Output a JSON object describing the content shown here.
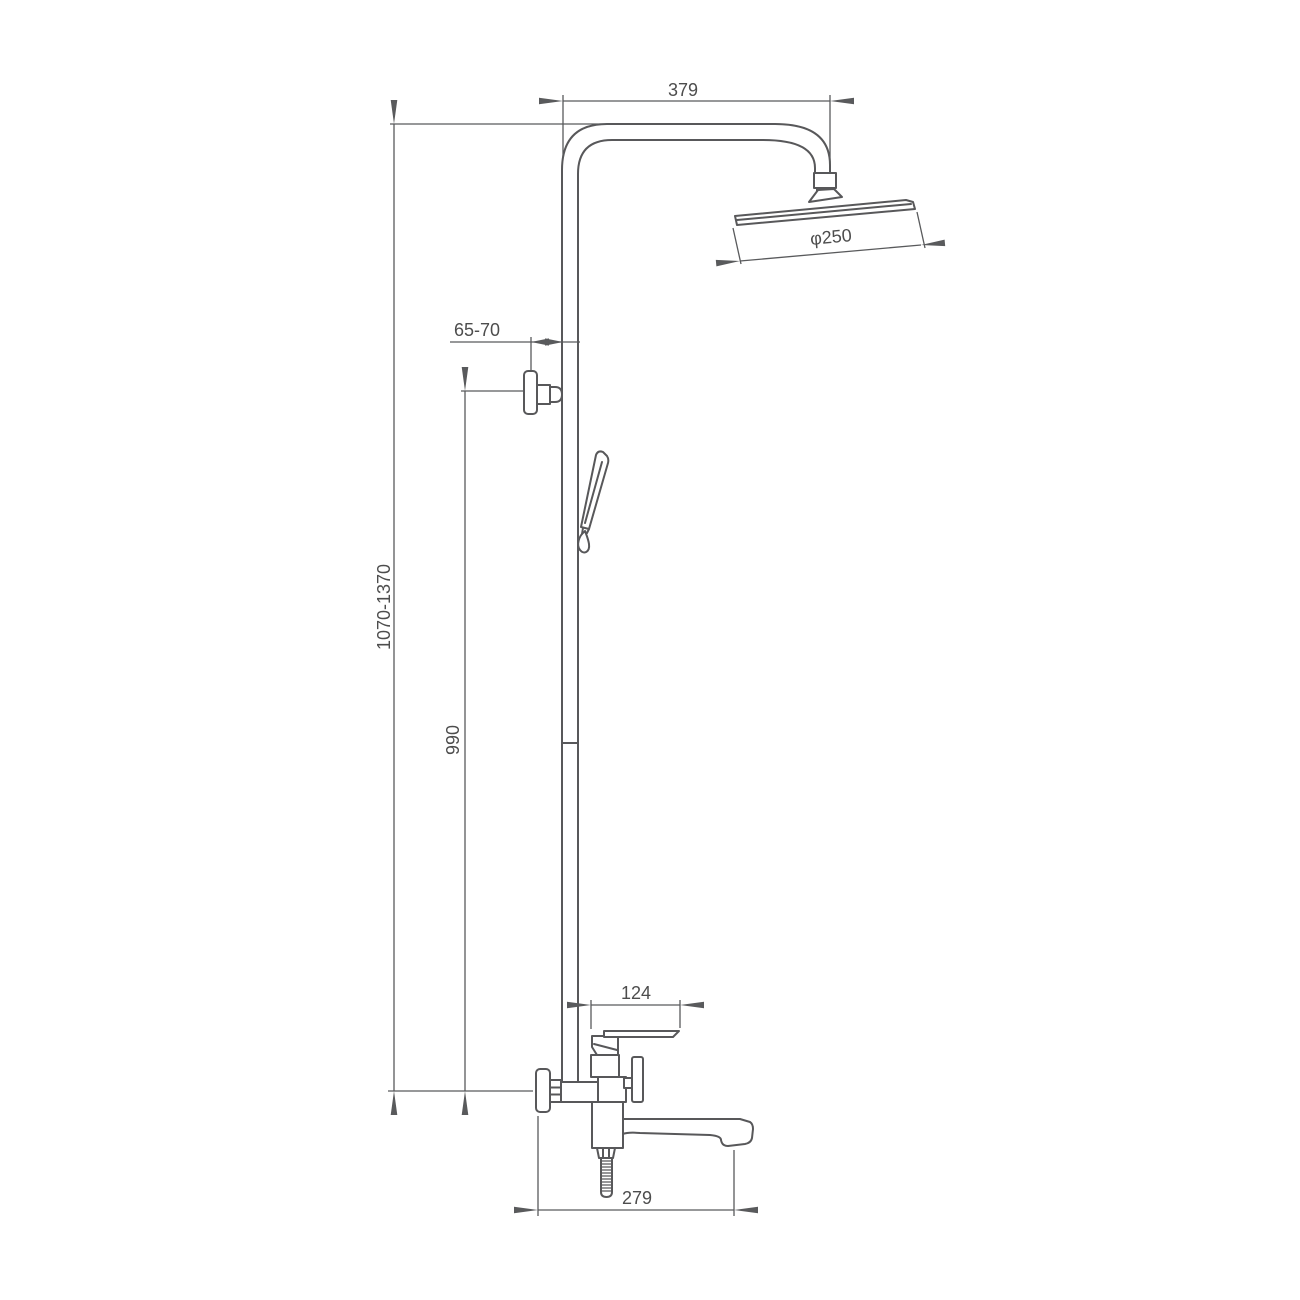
{
  "drawing": {
    "background": "#ffffff",
    "line_color": "#58585a",
    "text_color": "#4d4d4d",
    "labels": {
      "arm_reach": "379",
      "head_diameter": "φ250",
      "wall_offset": "65-70",
      "overall_height": "1070-1370",
      "riser_height": "990",
      "handle_width": "124",
      "spout_reach": "279"
    }
  }
}
